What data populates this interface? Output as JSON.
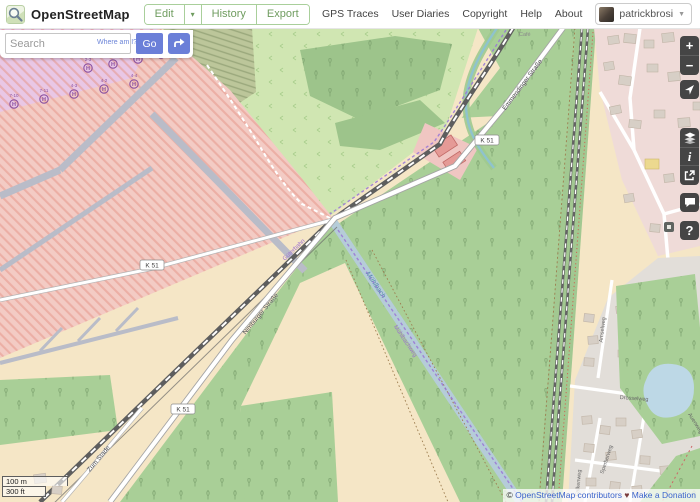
{
  "header": {
    "brand": "OpenStreetMap",
    "edit": "Edit",
    "history": "History",
    "export": "Export",
    "links": [
      "GPS Traces",
      "User Diaries",
      "Copyright",
      "Help",
      "About"
    ],
    "username": "patrickbrosi"
  },
  "search": {
    "placeholder": "Search",
    "where_am_i": "Where am I?",
    "go": "Go"
  },
  "controls": {
    "zoom_in": "+",
    "zoom_out": "−",
    "info": "i",
    "help": "?"
  },
  "map": {
    "badges": [
      "K 51",
      "K 51",
      "K 51"
    ],
    "helipad_h": "H",
    "helipads": {
      "row1": [
        "2-3",
        "2-4",
        "2-8",
        "2-9"
      ],
      "row2": [
        "7-10",
        "7-11",
        "4-3",
        "4-2",
        "4-4"
      ]
    },
    "labels": {
      "road_top": "Emmendinger Straße",
      "road_sw": "Nimburger Straße",
      "road_bl": "Zum Stade",
      "canal": "Mühlbach",
      "route_rail": "Güterbahn",
      "route_canal": "Mühlbachweg",
      "street_amsel": "Amselweg",
      "street_drossel": "Drosselweg",
      "street_sperber": "Sperberweg",
      "street_falken": "Falkenweg",
      "street_auen": "Auenweg",
      "cafe": "Café"
    },
    "scale": {
      "metric": "100 m",
      "imperial": "300 ft"
    },
    "attribution": {
      "copyright": "© ",
      "link": "OpenStreetMap contributors",
      "separator": " ♥ ",
      "donate": "Make a Donation"
    }
  },
  "colors": {
    "accent_green": "#6f9c5f",
    "button_blue": "#6b7fd8",
    "military_pink": "#f3cbc4",
    "forest": "#a9cf97",
    "water": "#b5ccd8"
  }
}
